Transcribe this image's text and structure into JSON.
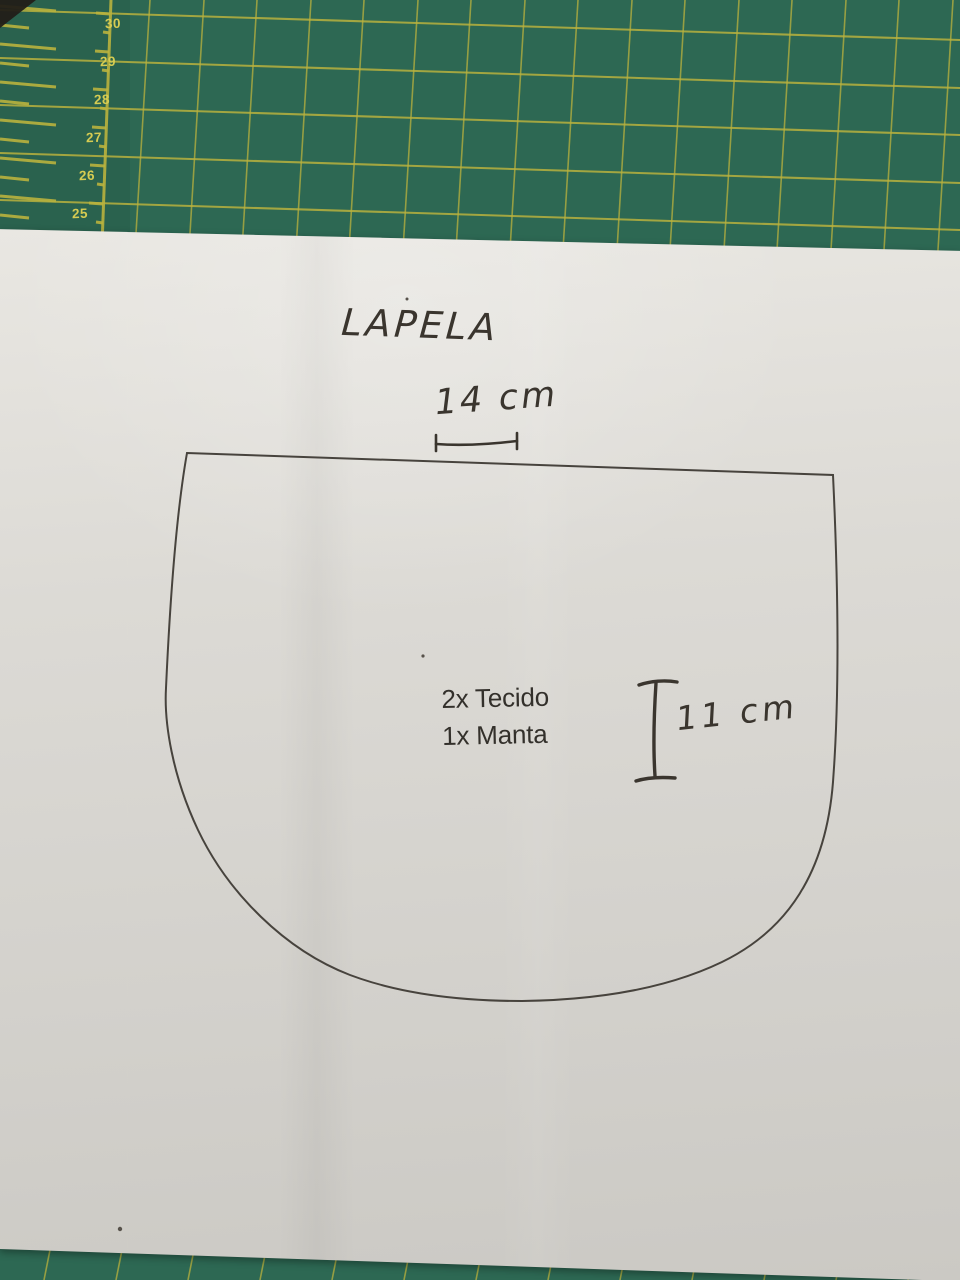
{
  "colors": {
    "mat_green": "#2d6853",
    "mat_grid": "#b9b23e",
    "mat_numbers": "#d6cc52",
    "paper": "#dcdad5",
    "ink": "#3a352e",
    "print_ink": "#33302b",
    "outline": "#47433d"
  },
  "mat": {
    "ruler_numbers": [
      "30",
      "29",
      "28",
      "27",
      "26",
      "25"
    ]
  },
  "paper": {
    "title": "LAPELA",
    "width_label": "14 cm",
    "height_label": "11 cm",
    "cut_instructions": [
      "2x Tecido",
      "1x Manta"
    ]
  }
}
